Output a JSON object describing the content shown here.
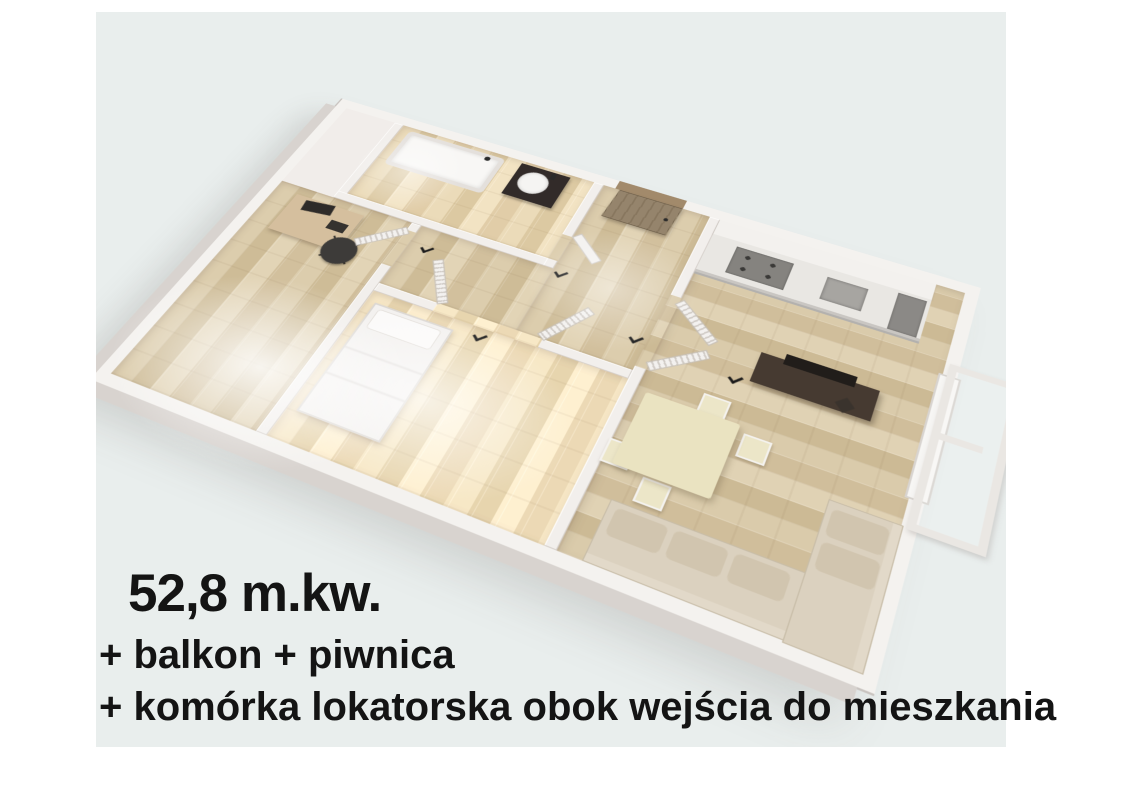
{
  "overlay": {
    "area": "52,8 m.kw.",
    "line2": "+ balkon + piwnica",
    "line3": "+ komórka lokatorska obok wejścia do mieszkania"
  },
  "palette": {
    "page_bg": "#ffffff",
    "photo_bg": "#e9eeed",
    "wall_white": "#f4f2ef",
    "wall_outer_shadow": "#d8d3cf",
    "wood_floor": "#d7c6a5",
    "entrance_door_brown": "#92805f",
    "dark_vanity": "#322b29",
    "tv_stand_brown": "#463a31",
    "sofa_beige": "#dbd1bf",
    "table_cream": "#eae3c1",
    "text_color": "#141414"
  },
  "floor_plan": {
    "view": "3d-top-down-render",
    "rooms": [
      {
        "name": "bathroom",
        "furniture": [
          "bathtub",
          "vanity-with-sink"
        ]
      },
      {
        "name": "office",
        "furniture": [
          "desk",
          "office-chair"
        ]
      },
      {
        "name": "hallway",
        "furniture": [
          "entrance-door"
        ]
      },
      {
        "name": "bedroom",
        "furniture": [
          "double-bed",
          "louvered-double-doors"
        ]
      },
      {
        "name": "kitchen",
        "furniture": [
          "upper-cabinets",
          "counter",
          "cooktop",
          "sink"
        ]
      },
      {
        "name": "living-room",
        "furniture": [
          "tv-stand",
          "tv",
          "dining-table",
          "dining-chairs",
          "corner-sofa"
        ]
      },
      {
        "name": "balcony",
        "furniture": [
          "balcony-window-railing"
        ]
      }
    ]
  }
}
